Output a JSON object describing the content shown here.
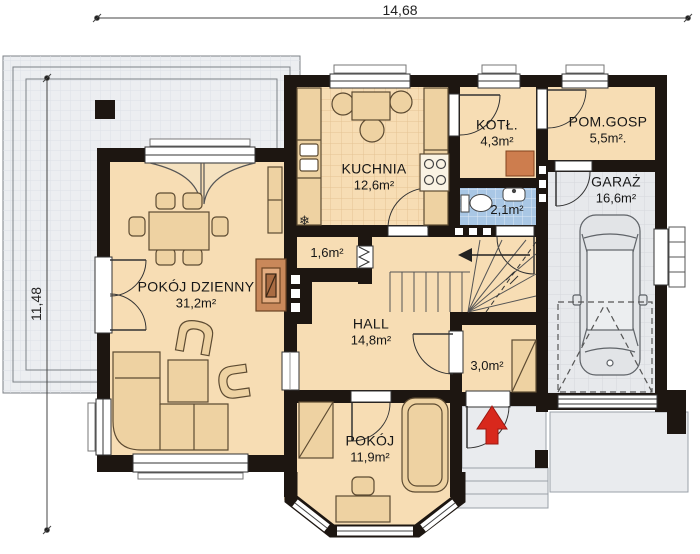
{
  "dimensions": {
    "width_label": "14,68",
    "height_label": "11,48"
  },
  "rooms": [
    {
      "id": "kuchnia",
      "name": "KUCHNIA",
      "area": "12,6m²"
    },
    {
      "id": "kotlownia",
      "name": "KOTŁ.",
      "area": "4,3m²"
    },
    {
      "id": "pom-gosp",
      "name": "POM.GOSP",
      "area": "5,5m²."
    },
    {
      "id": "garaz",
      "name": "GARAŻ",
      "area": "16,6m²"
    },
    {
      "id": "wc",
      "name": "",
      "area": "2,1m²"
    },
    {
      "id": "spizarka",
      "name": "",
      "area": "1,6m²"
    },
    {
      "id": "hall",
      "name": "HALL",
      "area": "14,8m²"
    },
    {
      "id": "pokoj-dzienny",
      "name": "POKÓJ DZIENNY",
      "area": "31,2m²"
    },
    {
      "id": "wiatrolap",
      "name": "",
      "area": "3,0m²"
    },
    {
      "id": "pokoj",
      "name": "POKÓJ",
      "area": "11,9m²"
    }
  ],
  "symbols": {
    "fridge_snowflake": "❄"
  },
  "colors": {
    "wall": "#1d1611",
    "floor": "#f7ddb4",
    "furniture": "#eed2a2",
    "terrace": "#eceef1",
    "wc_floor": "#a9c7e5",
    "garage_floor": "#e7e9ec",
    "boiler": "#cd7d4e",
    "fireplace": "#c9885a",
    "entry_arrow": "#d8281c"
  }
}
